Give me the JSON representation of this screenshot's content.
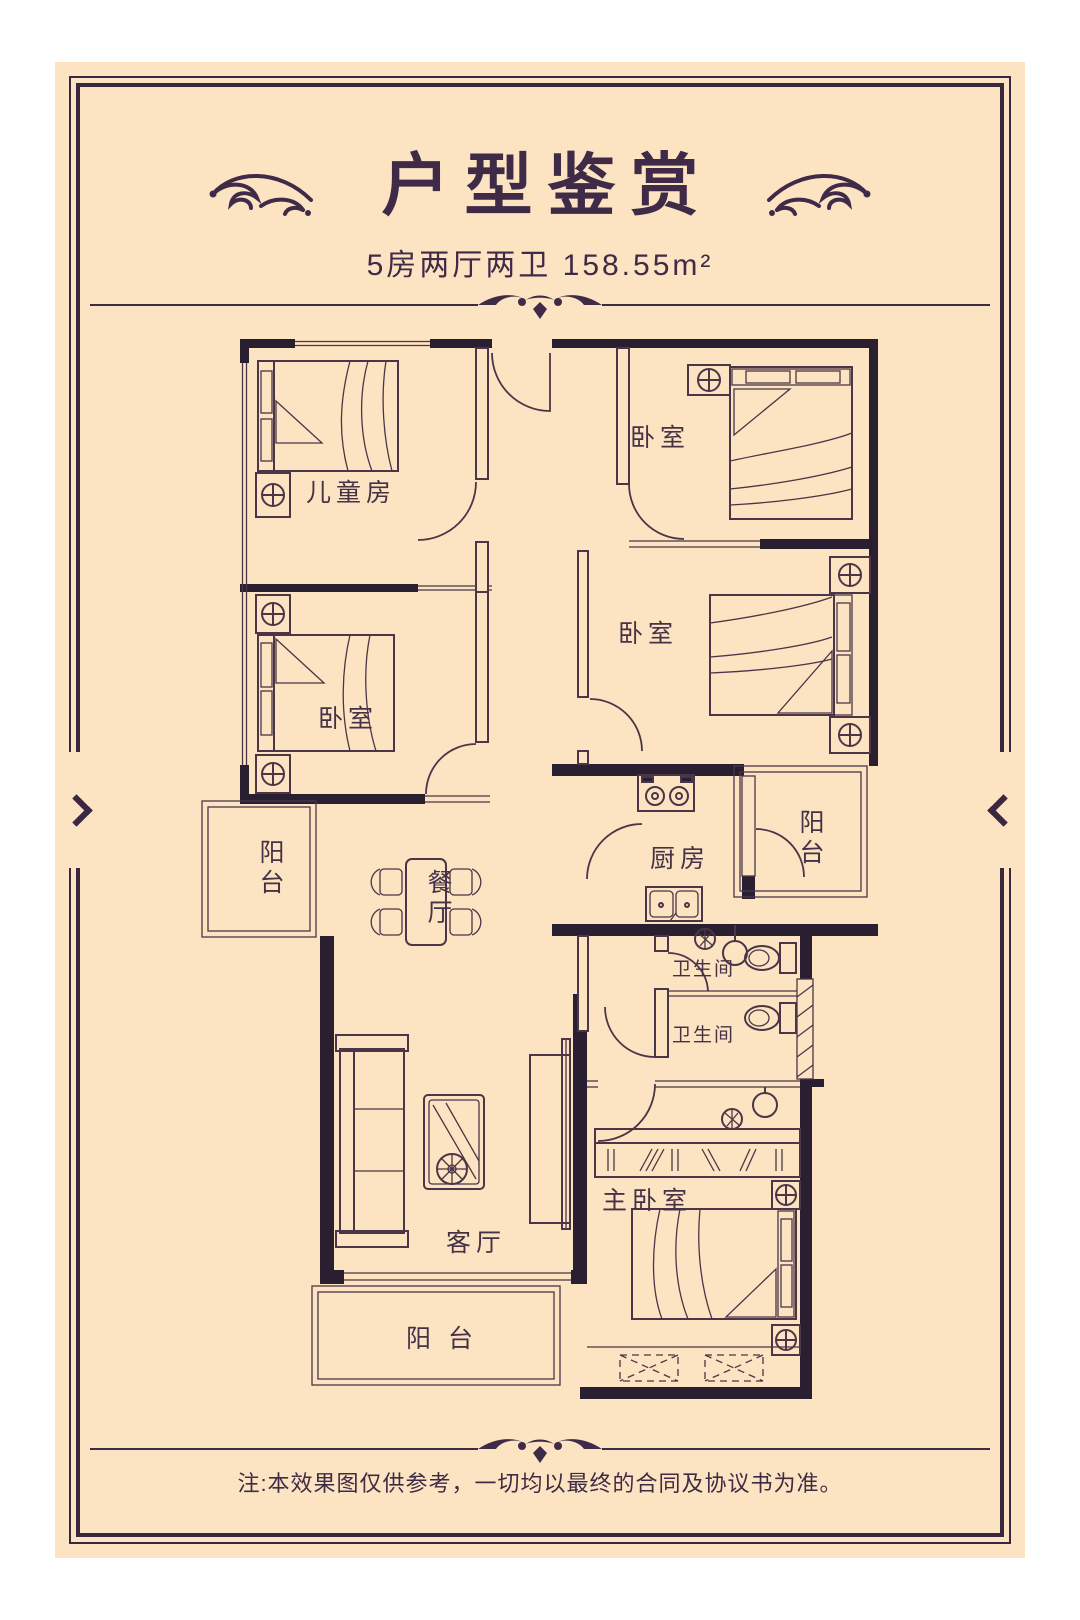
{
  "poster": {
    "title": "户型鉴赏",
    "subtitle": "5房两厅两卫  158.55m²",
    "footer_note": "注:本效果图仅供参考，一切均以最终的合同及协议书为准。"
  },
  "floor_plan": {
    "rooms": [
      {
        "id": "children-room",
        "label": "儿童房"
      },
      {
        "id": "bedroom-top-right",
        "label": "卧室"
      },
      {
        "id": "bedroom-mid-left",
        "label": "卧室"
      },
      {
        "id": "bedroom-mid-right",
        "label": "卧室"
      },
      {
        "id": "kitchen",
        "label": "厨房"
      },
      {
        "id": "balcony-right",
        "label": "阳台"
      },
      {
        "id": "balcony-left",
        "label": "阳台"
      },
      {
        "id": "dining-room",
        "label": "餐厅"
      },
      {
        "id": "bathroom-upper",
        "label": "卫生间"
      },
      {
        "id": "bathroom-lower",
        "label": "卫生间"
      },
      {
        "id": "master-bedroom",
        "label": "主卧室"
      },
      {
        "id": "living-room",
        "label": "客厅"
      },
      {
        "id": "balcony-bottom",
        "label": "阳 台"
      }
    ]
  },
  "icons": {
    "left_chevron": "prev-arrow",
    "right_chevron": "next-arrow",
    "flourish": "floral-scroll-ornament",
    "divider": "scroll-divider-ornament"
  },
  "colors": {
    "background_dark": "#342440",
    "background_light": "#463153",
    "card_background": "#fce3c1",
    "ink": "#3f2b47",
    "wall": "#2a1f31",
    "line": "#4a3647"
  }
}
